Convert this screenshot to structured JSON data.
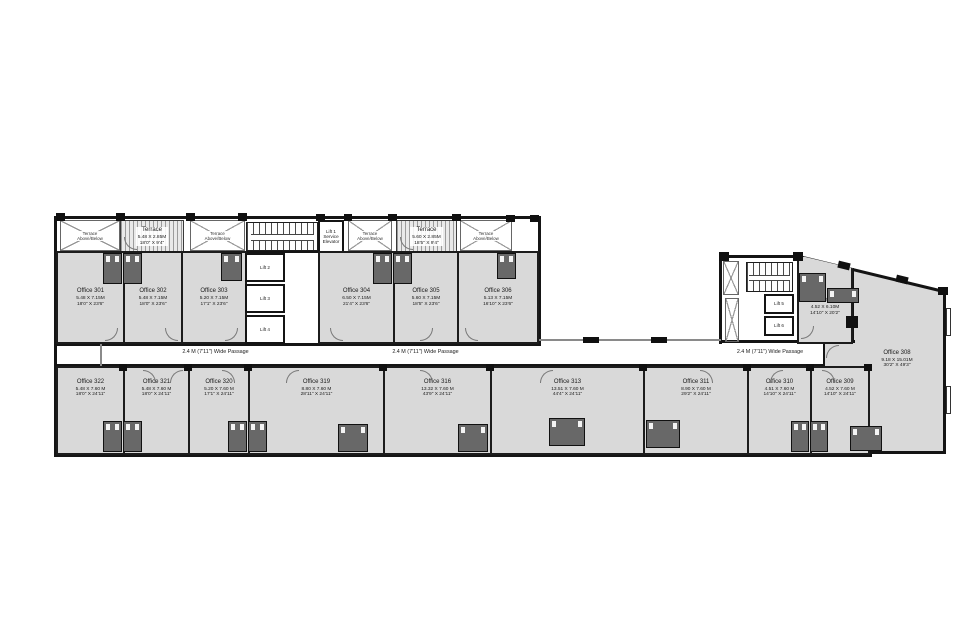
{
  "labels": {
    "passage": "2.4 M (7'11\") Wide Passage",
    "terrace_above": "Terrace",
    "terrace_above2": "Above/Below"
  },
  "terraces": {
    "t1": {
      "name": "Terrace",
      "m": "5.48 X 2.85M",
      "ft": "18'0\" X 9'4\""
    },
    "t2": {
      "name": "Terrace",
      "m": "5.60 X 2.85M",
      "ft": "18'5\" X 9'4\""
    }
  },
  "lifts": {
    "lift1a": "Lift 1",
    "lift1b": "Service",
    "lift1c": "Elevator",
    "lift2": "Lift 2",
    "lift3": "Lift 3",
    "lift4": "Lift 4",
    "lift5": "Lift 5",
    "lift6": "Lift 6"
  },
  "rooms": {
    "o301": {
      "name": "Office 301",
      "m": "5.48 X 7.15M",
      "ft": "18'0\" X 23'6\""
    },
    "o302": {
      "name": "Office 302",
      "m": "5.48 X 7.15M",
      "ft": "18'0\" X 23'6\""
    },
    "o303": {
      "name": "Office 303",
      "m": "5.20 X 7.15M",
      "ft": "17'1\" X 23'6\""
    },
    "o304": {
      "name": "Office 304",
      "m": "6.50 X 7.15M",
      "ft": "21'4\" X 23'6\""
    },
    "o305": {
      "name": "Office 305",
      "m": "5.60 X 7.15M",
      "ft": "18'5\" X 23'6\""
    },
    "o306": {
      "name": "Office 306",
      "m": "5.13 X 7.15M",
      "ft": "16'10\" X 23'6\""
    },
    "o307": {
      "name": "Office 307",
      "m": "4.52 X 6.10M",
      "ft": "14'10\" X 20'2\""
    },
    "o308": {
      "name": "Office 308",
      "m": "9.18 X 15.01M",
      "ft": "30'2\" X 49'3\""
    },
    "o309": {
      "name": "Office 309",
      "m": "4.52 X 7.60 M",
      "ft": "14'10\" X 24'11\""
    },
    "o310": {
      "name": "Office 310",
      "m": "4.51 X 7.60 M",
      "ft": "14'10\" X 24'11\""
    },
    "o311": {
      "name": "Office 311",
      "m": "8.90 X 7.60 M",
      "ft": "29'2\" X 24'11\""
    },
    "o313": {
      "name": "Office 313",
      "m": "13.51 X 7.60 M",
      "ft": "44'4\" X 24'11\""
    },
    "o316": {
      "name": "Office 316",
      "m": "13.32 X 7.60 M",
      "ft": "43'9\" X 24'11\""
    },
    "o319": {
      "name": "Office 319",
      "m": "8.80 X 7.60 M",
      "ft": "28'11\" X 24'11\""
    },
    "o320": {
      "name": "Office 320",
      "m": "5.20 X 7.60 M",
      "ft": "17'1\" X 24'11\""
    },
    "o321": {
      "name": "Office 321",
      "m": "5.48 X 7.60 M",
      "ft": "18'0\" X 24'11\""
    },
    "o322": {
      "name": "Office 322",
      "m": "5.48 X 7.60 M",
      "ft": "18'0\" X 24'11\""
    }
  }
}
